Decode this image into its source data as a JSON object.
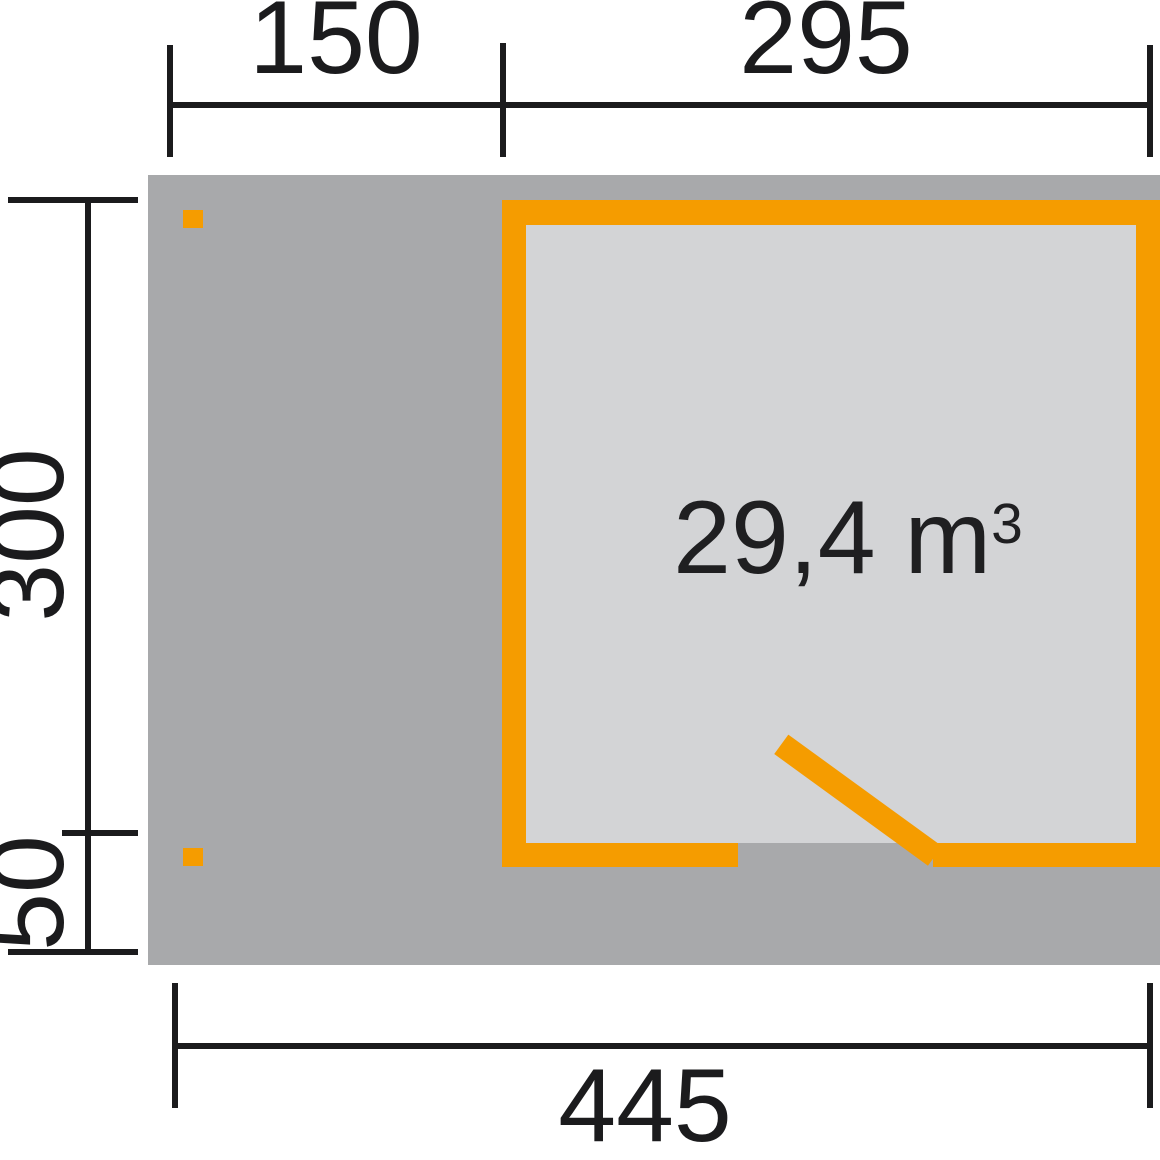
{
  "plan": {
    "volume": {
      "text": "29,4 m",
      "exponent": "3"
    },
    "dimensions": {
      "top_left_width": "150",
      "top_room_width": "295",
      "side_depth": "300",
      "side_overhang": "50",
      "bottom_total_width": "445"
    },
    "colors": {
      "accent_orange": "#f59c00",
      "platform_gray": "#a8a9ab",
      "interior_gray": "#d3d4d6",
      "dimension_black": "#1b1b1d",
      "background": "#ffffff"
    }
  }
}
